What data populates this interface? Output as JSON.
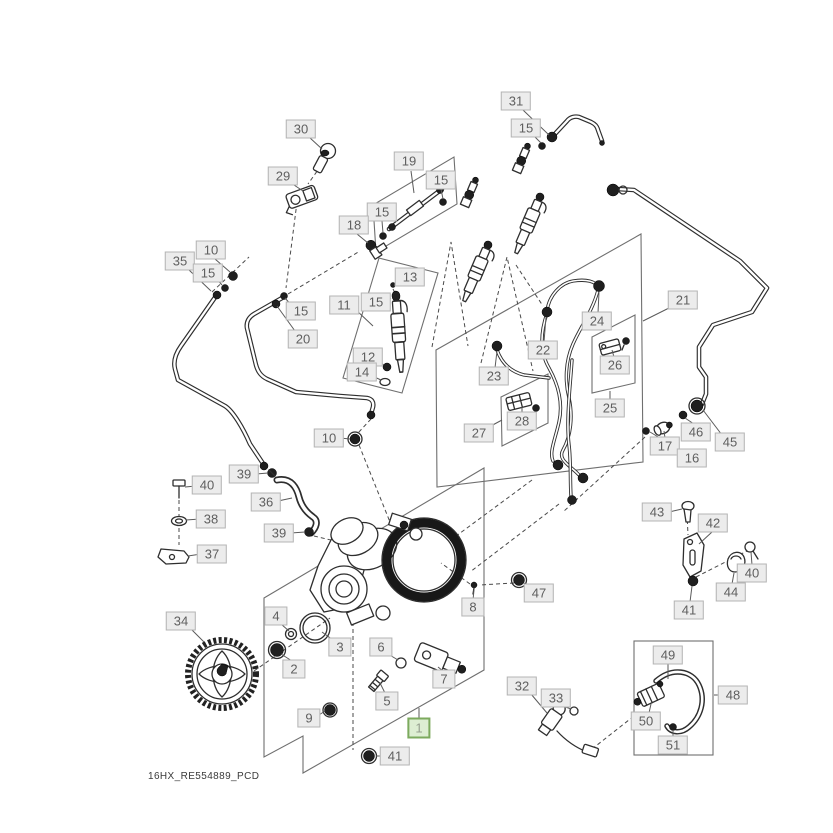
{
  "diagram": {
    "footer_code": "16HX_RE554889_PCD",
    "highlighted_part": "1"
  },
  "colors": {
    "label_bg": "#ececec",
    "label_border": "#b4b4b4",
    "label_text": "#5f5f5f",
    "highlight_bg": "#ddeed2",
    "highlight_border": "#7caa5e",
    "highlight_text": "#96a08f",
    "line_art": "#2e2e2e",
    "leader_line": "#5a5a5a"
  },
  "labels": [
    {
      "num": "30",
      "x": 301,
      "y": 129
    },
    {
      "num": "29",
      "x": 283,
      "y": 176
    },
    {
      "num": "19",
      "x": 409,
      "y": 161
    },
    {
      "num": "15",
      "x": 441,
      "y": 180
    },
    {
      "num": "15",
      "x": 382,
      "y": 212
    },
    {
      "num": "18",
      "x": 354,
      "y": 225
    },
    {
      "num": "13",
      "x": 410,
      "y": 277
    },
    {
      "num": "10",
      "x": 211,
      "y": 250
    },
    {
      "num": "35",
      "x": 180,
      "y": 261
    },
    {
      "num": "15",
      "x": 208,
      "y": 273
    },
    {
      "num": "15",
      "x": 301,
      "y": 311
    },
    {
      "num": "20",
      "x": 303,
      "y": 339
    },
    {
      "num": "11",
      "x": 344,
      "y": 305
    },
    {
      "num": "15",
      "x": 376,
      "y": 302
    },
    {
      "num": "12",
      "x": 368,
      "y": 357
    },
    {
      "num": "14",
      "x": 362,
      "y": 372
    },
    {
      "num": "31",
      "x": 516,
      "y": 101
    },
    {
      "num": "15",
      "x": 526,
      "y": 128
    },
    {
      "num": "21",
      "x": 683,
      "y": 300
    },
    {
      "num": "24",
      "x": 597,
      "y": 321
    },
    {
      "num": "22",
      "x": 543,
      "y": 350
    },
    {
      "num": "26",
      "x": 615,
      "y": 365
    },
    {
      "num": "23",
      "x": 494,
      "y": 376
    },
    {
      "num": "25",
      "x": 610,
      "y": 408
    },
    {
      "num": "28",
      "x": 522,
      "y": 421
    },
    {
      "num": "27",
      "x": 479,
      "y": 433
    },
    {
      "num": "46",
      "x": 696,
      "y": 432
    },
    {
      "num": "45",
      "x": 730,
      "y": 442
    },
    {
      "num": "17",
      "x": 665,
      "y": 446
    },
    {
      "num": "16",
      "x": 692,
      "y": 458
    },
    {
      "num": "10",
      "x": 329,
      "y": 438
    },
    {
      "num": "39",
      "x": 244,
      "y": 474
    },
    {
      "num": "40",
      "x": 207,
      "y": 485
    },
    {
      "num": "36",
      "x": 266,
      "y": 502
    },
    {
      "num": "38",
      "x": 211,
      "y": 519
    },
    {
      "num": "39",
      "x": 279,
      "y": 533
    },
    {
      "num": "37",
      "x": 212,
      "y": 554
    },
    {
      "num": "47",
      "x": 539,
      "y": 593
    },
    {
      "num": "8",
      "x": 473,
      "y": 607
    },
    {
      "num": "43",
      "x": 657,
      "y": 512
    },
    {
      "num": "42",
      "x": 713,
      "y": 523
    },
    {
      "num": "40",
      "x": 752,
      "y": 573
    },
    {
      "num": "44",
      "x": 731,
      "y": 592
    },
    {
      "num": "41",
      "x": 689,
      "y": 610
    },
    {
      "num": "34",
      "x": 181,
      "y": 621
    },
    {
      "num": "4",
      "x": 276,
      "y": 616
    },
    {
      "num": "2",
      "x": 294,
      "y": 669
    },
    {
      "num": "3",
      "x": 340,
      "y": 647
    },
    {
      "num": "6",
      "x": 381,
      "y": 647
    },
    {
      "num": "7",
      "x": 444,
      "y": 679
    },
    {
      "num": "5",
      "x": 387,
      "y": 701
    },
    {
      "num": "9",
      "x": 309,
      "y": 718
    },
    {
      "num": "1",
      "x": 419,
      "y": 728,
      "highlighted": true
    },
    {
      "num": "41",
      "x": 395,
      "y": 756
    },
    {
      "num": "32",
      "x": 522,
      "y": 686
    },
    {
      "num": "33",
      "x": 556,
      "y": 698
    },
    {
      "num": "49",
      "x": 668,
      "y": 655
    },
    {
      "num": "48",
      "x": 733,
      "y": 695
    },
    {
      "num": "50",
      "x": 646,
      "y": 721
    },
    {
      "num": "51",
      "x": 673,
      "y": 745
    }
  ]
}
